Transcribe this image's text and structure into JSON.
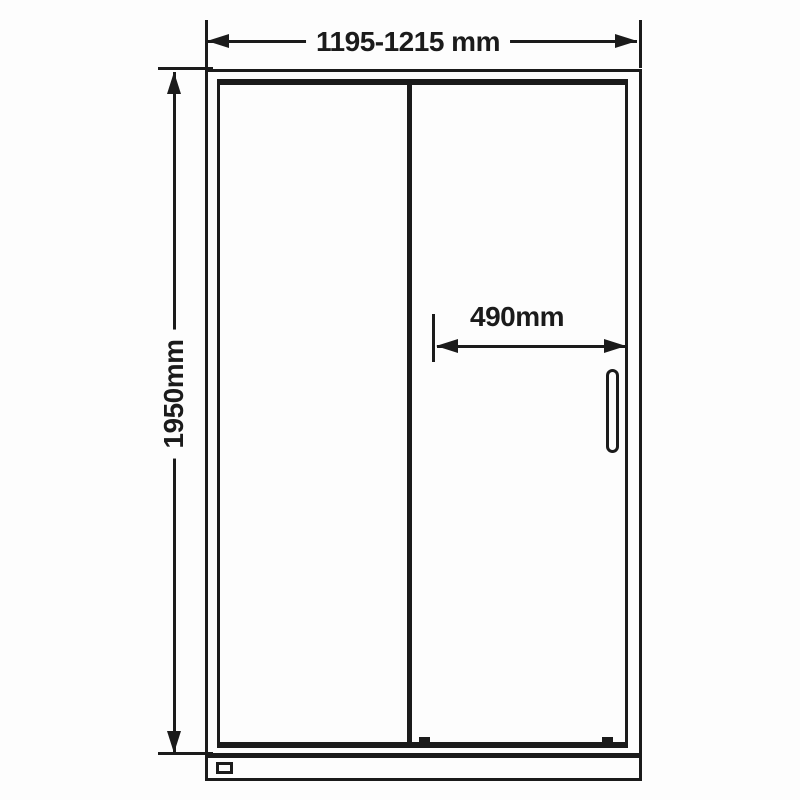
{
  "dimensions": {
    "overall_width": "1195-1215 mm",
    "overall_height": "1950mm",
    "door_opening": "490mm"
  },
  "colors": {
    "line": "#1b1b1b",
    "background": "#fdfdfd"
  }
}
